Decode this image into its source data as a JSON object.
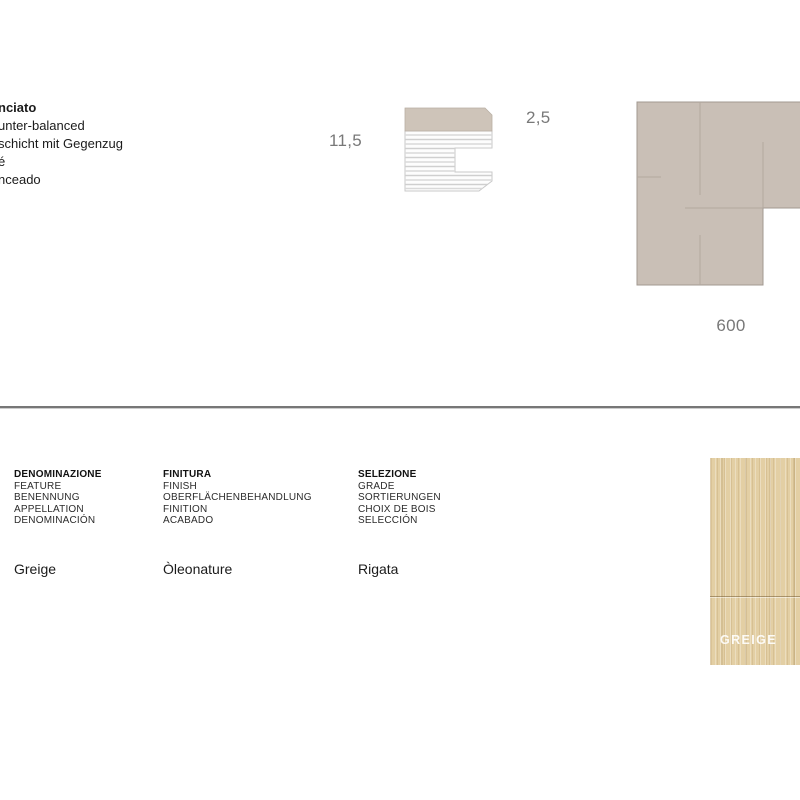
{
  "construction_note": {
    "lines": [
      "nciato",
      "unter-balanced",
      "schicht mit Gegenzug",
      "é",
      "nceado"
    ]
  },
  "cross_section_diagram": {
    "total_thickness_label": "11,5",
    "top_layer_thickness_label": "2,5"
  },
  "module_diagram": {
    "size_label": "600"
  },
  "spec_table": {
    "columns": [
      {
        "header_lines": [
          "DENOMINAZIONE",
          "FEATURE",
          "BENENNUNG",
          "APPELLATION",
          "DENOMINACIÓN"
        ],
        "value": "Greige"
      },
      {
        "header_lines": [
          "FINITURA",
          "FINISH",
          "OBERFLÄCHENBEHANDLUNG",
          "FINITION",
          "ACABADO"
        ],
        "value": "Òleonature"
      },
      {
        "header_lines": [
          "SELEZIONE",
          "GRADE",
          "SORTIERUNGEN",
          "CHOIX DE BOIS",
          "SELECCIÓN"
        ],
        "value": "Rigata"
      }
    ]
  },
  "swatch": {
    "label": "GREIGE"
  },
  "colors": {
    "surface_layer_beige": "#cec4b9",
    "module_taupe": "#c9bfb6",
    "module_seam": "#b2a89f",
    "dimension_text_gray": "#787878",
    "wood_swatch_base": "#e3cfa4",
    "divider_gray": "#777777"
  }
}
